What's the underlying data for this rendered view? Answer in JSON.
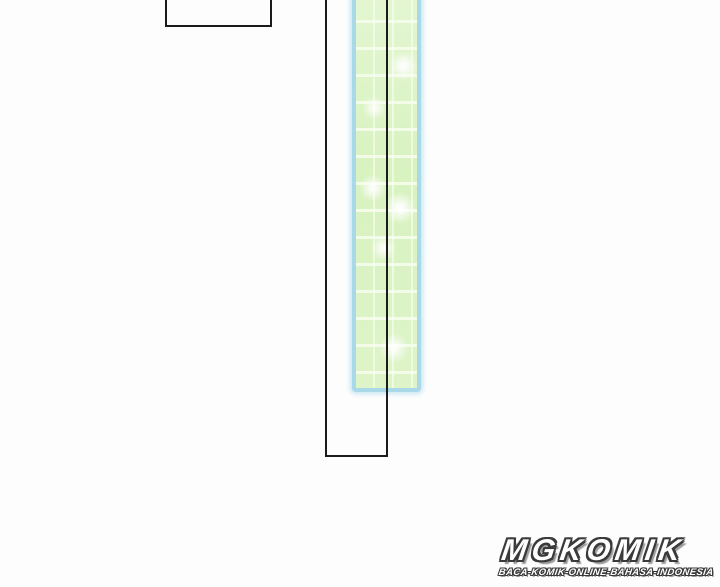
{
  "watermark": {
    "title": "MGKOMIK",
    "tagline": "BACA-KOMIK-ONLINE-BAHASA-INDONESIA"
  },
  "colors": {
    "background": "#fdfdfd",
    "panel_outline": "#1b1b1b",
    "beam_border": "#a9d9e8",
    "beam_fill": "#dcf3c6",
    "logo_fill": "#ffffff",
    "logo_outline": "#3a3a3a",
    "logo_shadow": "#9a9a9a"
  }
}
